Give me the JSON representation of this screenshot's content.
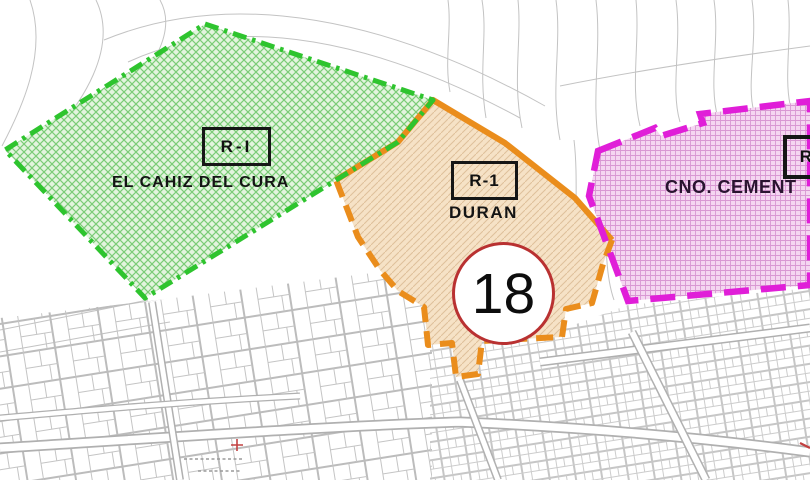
{
  "map": {
    "description": "Cadastral zoning plan with three highlighted sectors",
    "zones": [
      {
        "code": "R-I",
        "name": "EL CAHIZ DEL CURA",
        "fill_color": "#e3f4de",
        "hatch_color": "#7acc76",
        "hatch_style": "diagonal-crosshatch",
        "border_color": "#2ec42e",
        "border_style": "dash-dot"
      },
      {
        "code": "R-1",
        "name": "DURAN",
        "fill_color": "#f6e2c6",
        "hatch_color": "#dec09a",
        "hatch_style": "diagonal-hatch",
        "border_color": "#ea8d1c",
        "border_style": "solid-top-dashed-bottom"
      },
      {
        "code": "R-1",
        "name": "CNO. CEMENT",
        "fill_color": "#f5d6f1",
        "hatch_color": "#d998d3",
        "hatch_style": "fine-grid",
        "border_color": "#e01ed8",
        "border_style": "dashed"
      }
    ],
    "marker": {
      "number": "18",
      "ring_color": "#b93131",
      "fill_color": "#ffffff"
    },
    "base_map": {
      "line_color": "#c3c3c3",
      "street_edge_color": "#b0b0b0",
      "red_mark_color": "#c24040"
    }
  }
}
